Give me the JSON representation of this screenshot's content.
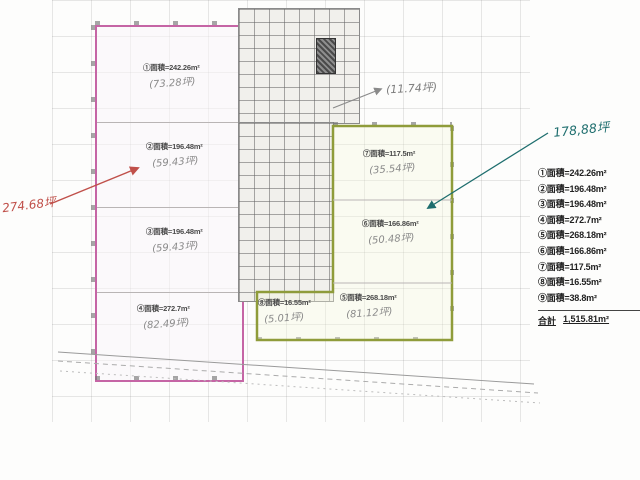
{
  "plan": {
    "units": [
      {
        "label": "①面積=242.26m²",
        "note": "(73.28坪)"
      },
      {
        "label": "②面積=196.48m²",
        "note": "(59.43坪)"
      },
      {
        "label": "③面積=196.48m²",
        "note": "(59.43坪)"
      },
      {
        "label": "④面積=272.7m²",
        "note": "(82.49坪)"
      },
      {
        "label": "⑤面積=268.18m²",
        "note": "(81.12坪)"
      },
      {
        "label": "⑥面積=166.86m²",
        "note": "(50.48坪)"
      },
      {
        "label": "⑦面積=117.5m²",
        "note": "(35.54坪)"
      },
      {
        "label": "⑧面積=16.55m²",
        "note": "(5.01坪)"
      }
    ],
    "annotations": {
      "red_total": "274.68坪",
      "teal_total": "178,88坪",
      "pencil_note": "(11.74坪)"
    },
    "colors": {
      "left_outline": "#c565a5",
      "right_outline": "#8f9c3a",
      "red_ink": "#c0504a",
      "teal_ink": "#1e6e6e",
      "pencil": "#8a8a8a"
    }
  },
  "legend": {
    "items": [
      "①面積=242.26m²",
      "②面積=196.48m²",
      "③面積=196.48m²",
      "④面積=272.7m²",
      "⑤面積=268.18m²",
      "⑥面積=166.86m²",
      "⑦面積=117.5m²",
      "⑧面積=16.55m²",
      "⑨面積=38.8m²"
    ],
    "total_label": "合計",
    "total_value": "1,515.81m²"
  }
}
